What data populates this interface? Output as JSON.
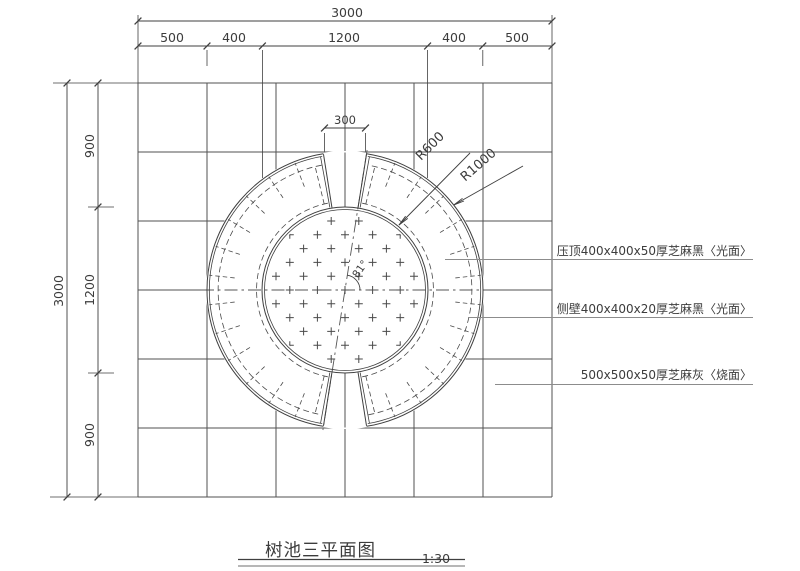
{
  "drawing": {
    "title": "树池三平面图",
    "scale": "1:30",
    "dim_top_total": "3000",
    "dim_top_segments": [
      "500",
      "400",
      "1200",
      "400",
      "500"
    ],
    "dim_left_total": "3000",
    "dim_left_segments": [
      "900",
      "1200",
      "900"
    ],
    "dim_gap": "300",
    "radius_inner_label": "R600",
    "radius_outer_label": "R1000",
    "angle_label": "81°",
    "callouts": [
      "压顶400x400x50厚芝麻黑〈光面〉",
      "侧壁400x400x20厚芝麻黑〈光面〉",
      "500x500x50厚芝麻灰〈烧面〉"
    ],
    "colors": {
      "line": "#3f3f3f",
      "grid": "#525252",
      "dash": "#4a4a4a",
      "centerline": "#555555",
      "leader": "#8c8c8c",
      "text": "#3c3c3c",
      "background": "#ffffff"
    }
  }
}
